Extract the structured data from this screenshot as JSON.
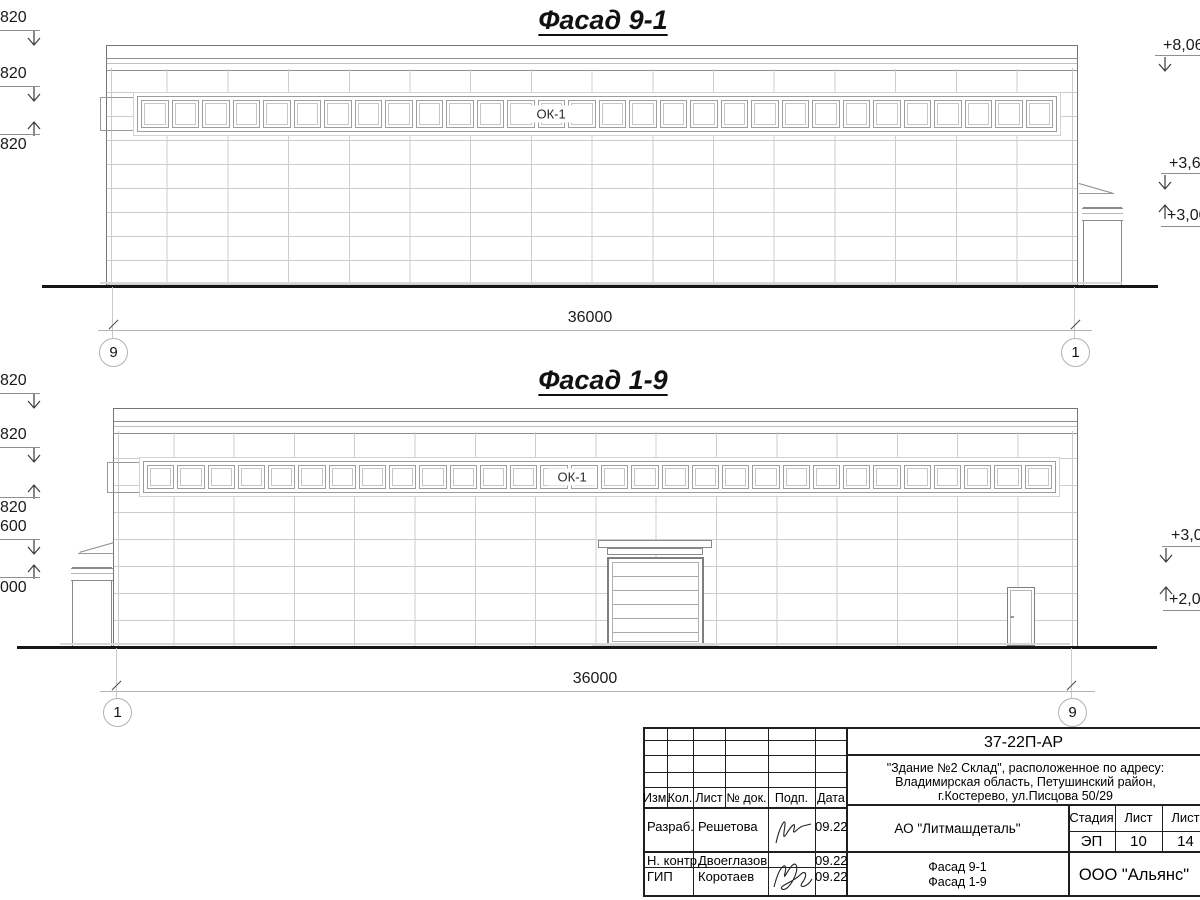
{
  "facade_91": {
    "title": "Фасад 9-1",
    "window_label": "ОК-1",
    "window_count": 30,
    "dimension": "36000",
    "axis_left": "9",
    "axis_right": "1",
    "left_marks": [
      "820",
      "820",
      "820"
    ],
    "right_marks": [
      "+8,06",
      "+3,60",
      "+3,00"
    ]
  },
  "facade_19": {
    "title": "Фасад 1-9",
    "window_label": "ОК-1",
    "window_count": 30,
    "dimension": "36000",
    "axis_left": "1",
    "axis_right": "9",
    "left_marks": [
      "820",
      "820",
      "820",
      "600",
      "000"
    ],
    "right_marks": [
      "+3,0",
      "+2,00"
    ]
  },
  "title_block": {
    "doc_code": "37-22П-АР",
    "address_line1": "\"Здание №2 Склад\", расположенное по адресу:",
    "address_line2": "Владимирская область, Петушинский район,",
    "address_line3": "г.Костерево, ул.Писцова 50/29",
    "columns": [
      "Изм.",
      "Кол.",
      "Лист",
      "№ док.",
      "Подп.",
      "Дата"
    ],
    "rows": [
      {
        "role": "Разраб.",
        "name": "Решетова",
        "date": "09.22"
      },
      {
        "role": "Н. контр.",
        "name": "Двоеглазов",
        "date": "09.22"
      },
      {
        "role": "ГИП",
        "name": "Коротаев",
        "date": "09.22"
      }
    ],
    "client": "АО \"Литмашдеталь\"",
    "stage_label": "Стадия",
    "sheet_label": "Лист",
    "sheets_label": "Лист",
    "stage": "ЭП",
    "sheet": "10",
    "sheets": "14",
    "sheet_name_line1": "Фасад 9-1",
    "sheet_name_line2": "Фасад 1-9",
    "company": "ООО \"Альянс\""
  }
}
